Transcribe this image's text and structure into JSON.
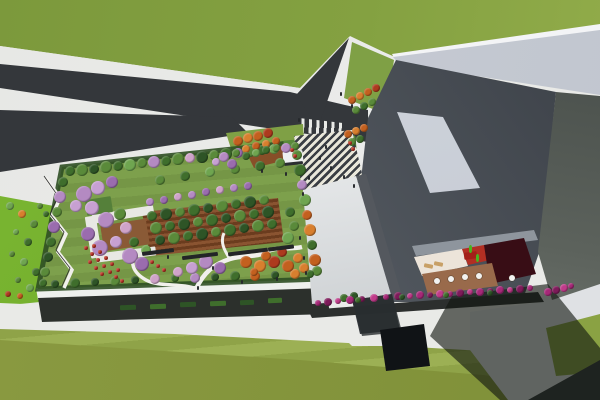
{
  "scene": {
    "description": "Aerial 3D architectural rendering: rooftop garden park over a long low building, Y-shaped asphalt road through lawns, grand striped entry stair plaza, angular dark-gray tower slabs with a courtyard terrace, cafe tables and magenta flower beds",
    "canvas": {
      "width": 600,
      "height": 400
    }
  },
  "palette": {
    "lawn_stripe_a": "#9cb054",
    "lawn_stripe_b": "#8fa348",
    "lawn_fore": "#8a9a41",
    "lawn_fore2": "#7f9038",
    "slope_green": "#7cb832",
    "road": "#34373b",
    "road_dark": "#2b2e32",
    "sidewalk": "#e9eae7",
    "garden_lawn": "#7da04c",
    "garden_lawn2": "#759646",
    "hedge": "#2f4f24",
    "g1": "#3f6e2c",
    "g2": "#5a8a3a",
    "g3": "#6fa550",
    "g4": "#2e5426",
    "p1": "#b48ac2",
    "p2": "#c7a0d2",
    "p3": "#9a6cae",
    "pk": "#cfa3c9",
    "o1": "#c3601f",
    "o2": "#d87f2e",
    "r1": "#ad3a1e",
    "rf": "#c03526",
    "path": "#f1f0ec",
    "pergola": "#6b3c1e",
    "pergola_l": "#8a5431",
    "bench": "#232527",
    "wall_dark": "#2c302c",
    "fascia": "#eef0ed",
    "fascia2": "#e8e8e3",
    "deck2": "#8a5a36",
    "groof": "#55803a",
    "canopy_w": "#eef0f1",
    "roof_edge": "#f3f4f6",
    "terrace_cream": "#ece4d9",
    "terrace_red": "#b22f23",
    "terrace_maroon": "#380d15",
    "deck": "#996a4b",
    "table_white": "#f2f2f0",
    "fig_green": "#49b41e",
    "chair_tan": "#c8a066",
    "red_wall": "#a32018",
    "fl1": "#a62878",
    "fl2": "#7e1b5a",
    "fl3": "#c03b8a",
    "planter": "#2c2f2e",
    "shadow": "rgba(18,22,16,0.62)",
    "leg_dark": "#101316",
    "ground_light": "#dfe1e4",
    "stair_a": "#3a3e44",
    "stair_b": "#e9e7da",
    "people": "#26292c"
  },
  "scatter": {
    "garden_trees": [
      [
        70,
        171,
        5,
        "g1"
      ],
      [
        82,
        170,
        6,
        "g2"
      ],
      [
        94,
        169,
        5,
        "g4"
      ],
      [
        106,
        167,
        6,
        "g2"
      ],
      [
        118,
        166,
        5,
        "g1"
      ],
      [
        130,
        165,
        6,
        "g3"
      ],
      [
        142,
        163,
        5,
        "g2"
      ],
      [
        154,
        162,
        6,
        "p1"
      ],
      [
        166,
        161,
        5,
        "g1"
      ],
      [
        178,
        159,
        6,
        "g2"
      ],
      [
        190,
        158,
        5,
        "pk"
      ],
      [
        202,
        157,
        6,
        "g4"
      ],
      [
        214,
        155,
        5,
        "g2"
      ],
      [
        226,
        154,
        6,
        "g1"
      ],
      [
        238,
        153,
        5,
        "p3"
      ],
      [
        250,
        151,
        6,
        "g2"
      ],
      [
        262,
        150,
        5,
        "g1"
      ],
      [
        274,
        149,
        5,
        "g3"
      ],
      [
        286,
        148,
        5,
        "p1"
      ],
      [
        295,
        146,
        4,
        "g2"
      ],
      [
        297,
        155,
        5,
        "g2"
      ],
      [
        300,
        170,
        6,
        "g1"
      ],
      [
        302,
        185,
        5,
        "p1"
      ],
      [
        305,
        200,
        6,
        "g3"
      ],
      [
        307,
        215,
        5,
        "o1"
      ],
      [
        310,
        230,
        6,
        "o2"
      ],
      [
        312,
        245,
        5,
        "g1"
      ],
      [
        315,
        260,
        6,
        "o1"
      ],
      [
        317,
        271,
        5,
        "g2"
      ],
      [
        55,
        284,
        4,
        "g4"
      ],
      [
        75,
        283,
        5,
        "g1"
      ],
      [
        95,
        282,
        4,
        "g4"
      ],
      [
        115,
        281,
        5,
        "g2"
      ],
      [
        135,
        280,
        4,
        "g4"
      ],
      [
        155,
        279,
        5,
        "pk"
      ],
      [
        175,
        278,
        4,
        "g1"
      ],
      [
        195,
        278,
        5,
        "p1"
      ],
      [
        215,
        277,
        4,
        "g4"
      ],
      [
        235,
        276,
        5,
        "g1"
      ],
      [
        255,
        276,
        5,
        "o1"
      ],
      [
        275,
        275,
        4,
        "g4"
      ],
      [
        295,
        274,
        5,
        "o2"
      ],
      [
        310,
        274,
        4,
        "g1"
      ],
      [
        63,
        182,
        5,
        "g1"
      ],
      [
        60,
        197,
        6,
        "p1"
      ],
      [
        57,
        212,
        5,
        "g2"
      ],
      [
        54,
        227,
        6,
        "p3"
      ],
      [
        51,
        242,
        5,
        "g1"
      ],
      [
        48,
        257,
        5,
        "g4"
      ],
      [
        45,
        272,
        5,
        "g2"
      ],
      [
        43,
        283,
        4,
        "g1"
      ],
      [
        84,
        194,
        8,
        "p1"
      ],
      [
        98,
        188,
        7,
        "p2"
      ],
      [
        112,
        182,
        6,
        "p3"
      ],
      [
        92,
        208,
        7,
        "p2"
      ],
      [
        106,
        220,
        8,
        "p1"
      ],
      [
        88,
        234,
        7,
        "p3"
      ],
      [
        100,
        248,
        8,
        "p1"
      ],
      [
        116,
        242,
        6,
        "p2"
      ],
      [
        130,
        256,
        8,
        "p1"
      ],
      [
        142,
        264,
        7,
        "p3"
      ],
      [
        126,
        228,
        6,
        "pk"
      ],
      [
        76,
        206,
        6,
        "p2"
      ],
      [
        120,
        214,
        6,
        "g2"
      ],
      [
        134,
        242,
        5,
        "g1"
      ],
      [
        146,
        250,
        5,
        "g3"
      ],
      [
        150,
        202,
        4,
        "p1"
      ],
      [
        164,
        200,
        4,
        "p3"
      ],
      [
        178,
        197,
        4,
        "pk"
      ],
      [
        192,
        195,
        4,
        "p1"
      ],
      [
        206,
        192,
        4,
        "p3"
      ],
      [
        220,
        190,
        4,
        "pk"
      ],
      [
        234,
        188,
        4,
        "p1"
      ],
      [
        248,
        186,
        4,
        "p3"
      ],
      [
        160,
        180,
        5,
        "g2"
      ],
      [
        185,
        176,
        5,
        "g1"
      ],
      [
        210,
        172,
        5,
        "g3"
      ],
      [
        235,
        169,
        5,
        "g2"
      ],
      [
        260,
        166,
        5,
        "g1"
      ],
      [
        280,
        163,
        5,
        "g2"
      ],
      [
        152,
        216,
        5,
        "g1"
      ],
      [
        166,
        214,
        6,
        "g4"
      ],
      [
        180,
        212,
        5,
        "g2"
      ],
      [
        194,
        210,
        6,
        "g1"
      ],
      [
        208,
        208,
        5,
        "g4"
      ],
      [
        222,
        206,
        6,
        "g2"
      ],
      [
        236,
        204,
        5,
        "g1"
      ],
      [
        250,
        202,
        6,
        "g4"
      ],
      [
        264,
        200,
        5,
        "g2"
      ],
      [
        156,
        228,
        6,
        "g2"
      ],
      [
        170,
        226,
        5,
        "g1"
      ],
      [
        184,
        224,
        6,
        "g4"
      ],
      [
        198,
        222,
        5,
        "g2"
      ],
      [
        212,
        220,
        6,
        "g1"
      ],
      [
        226,
        218,
        5,
        "g4"
      ],
      [
        240,
        216,
        6,
        "g2"
      ],
      [
        254,
        214,
        5,
        "g1"
      ],
      [
        268,
        212,
        6,
        "g4"
      ],
      [
        160,
        240,
        5,
        "g4"
      ],
      [
        174,
        238,
        6,
        "g2"
      ],
      [
        188,
        236,
        5,
        "g1"
      ],
      [
        202,
        234,
        6,
        "g4"
      ],
      [
        216,
        232,
        5,
        "g2"
      ],
      [
        230,
        230,
        6,
        "g1"
      ],
      [
        244,
        228,
        5,
        "g4"
      ],
      [
        258,
        226,
        6,
        "g2"
      ],
      [
        272,
        224,
        5,
        "g1"
      ],
      [
        246,
        262,
        6,
        "o1"
      ],
      [
        260,
        266,
        6,
        "o2"
      ],
      [
        274,
        262,
        6,
        "r1"
      ],
      [
        288,
        266,
        6,
        "o1"
      ],
      [
        298,
        258,
        5,
        "o2"
      ],
      [
        282,
        252,
        5,
        "r1"
      ],
      [
        266,
        256,
        5,
        "o1"
      ],
      [
        304,
        268,
        5,
        "o2"
      ],
      [
        254,
        272,
        4,
        "o1"
      ],
      [
        206,
        262,
        7,
        "p1"
      ],
      [
        220,
        268,
        6,
        "p3"
      ],
      [
        192,
        268,
        6,
        "p2"
      ],
      [
        178,
        272,
        5,
        "pk"
      ],
      [
        288,
        238,
        6,
        "g3"
      ],
      [
        294,
        226,
        5,
        "g2"
      ],
      [
        290,
        212,
        5,
        "g1"
      ]
    ],
    "plaza_trees": [
      [
        238,
        141,
        5,
        "o1"
      ],
      [
        248,
        138,
        5,
        "o2"
      ],
      [
        258,
        136,
        5,
        "o1"
      ],
      [
        268,
        133,
        5,
        "r1"
      ],
      [
        246,
        149,
        4,
        "o2"
      ],
      [
        256,
        146,
        4,
        "o1"
      ],
      [
        266,
        144,
        4,
        "o2"
      ],
      [
        276,
        141,
        4,
        "o1"
      ],
      [
        224,
        157,
        5,
        "p1"
      ],
      [
        232,
        164,
        5,
        "p3"
      ],
      [
        216,
        162,
        4,
        "p2"
      ],
      [
        236,
        153,
        4,
        "g2"
      ],
      [
        246,
        156,
        4,
        "g1"
      ],
      [
        256,
        153,
        4,
        "g3"
      ],
      [
        266,
        150,
        4,
        "g1"
      ],
      [
        276,
        148,
        4,
        "g2"
      ],
      [
        348,
        134,
        4,
        "o1"
      ],
      [
        356,
        131,
        4,
        "o2"
      ],
      [
        364,
        128,
        4,
        "o1"
      ],
      [
        352,
        142,
        4,
        "g2"
      ],
      [
        360,
        139,
        4,
        "g1"
      ],
      [
        352,
        100,
        4,
        "o1"
      ],
      [
        360,
        96,
        4,
        "o2"
      ],
      [
        368,
        92,
        4,
        "o1"
      ],
      [
        376,
        88,
        4,
        "r1"
      ],
      [
        356,
        110,
        4,
        "g2"
      ],
      [
        364,
        106,
        4,
        "g1"
      ],
      [
        372,
        102,
        4,
        "g2"
      ],
      [
        344,
        298,
        4,
        "g1"
      ],
      [
        354,
        296,
        4,
        "g4"
      ]
    ],
    "slope_shrubs": [
      [
        10,
        206,
        4,
        "g3"
      ],
      [
        22,
        214,
        4,
        "o2"
      ],
      [
        34,
        224,
        4,
        "g2"
      ],
      [
        16,
        232,
        3,
        "g3"
      ],
      [
        28,
        242,
        4,
        "g1"
      ],
      [
        12,
        254,
        3,
        "g2"
      ],
      [
        24,
        262,
        4,
        "g3"
      ],
      [
        36,
        272,
        4,
        "g1"
      ],
      [
        18,
        280,
        3,
        "g2"
      ],
      [
        30,
        288,
        4,
        "g3"
      ],
      [
        8,
        294,
        3,
        "r1"
      ],
      [
        20,
        296,
        3,
        "o1"
      ],
      [
        40,
        206,
        3,
        "g2"
      ],
      [
        46,
        214,
        3,
        "g1"
      ]
    ],
    "red_flowers": [
      [
        86,
        248
      ],
      [
        92,
        254
      ],
      [
        98,
        260
      ],
      [
        104,
        266
      ],
      [
        110,
        272
      ],
      [
        116,
        277
      ],
      [
        122,
        281
      ],
      [
        94,
        246
      ],
      [
        100,
        252
      ],
      [
        106,
        258
      ],
      [
        112,
        264
      ],
      [
        118,
        270
      ],
      [
        90,
        262
      ],
      [
        96,
        268
      ],
      [
        102,
        274
      ],
      [
        152,
        262
      ],
      [
        158,
        266
      ],
      [
        164,
        270
      ],
      [
        292,
        150
      ],
      [
        295,
        156
      ],
      [
        350,
        143
      ],
      [
        353,
        149
      ]
    ],
    "magenta_flowers": [
      [
        318,
        303,
        3,
        "fl1"
      ],
      [
        328,
        302,
        4,
        "fl2"
      ],
      [
        338,
        301,
        3,
        "fl3"
      ],
      [
        350,
        300,
        4,
        "fl1"
      ],
      [
        362,
        299,
        3,
        "fl2"
      ],
      [
        374,
        298,
        4,
        "fl3"
      ],
      [
        386,
        297,
        3,
        "fl1"
      ],
      [
        398,
        296,
        4,
        "fl2"
      ],
      [
        410,
        296,
        3,
        "fl3"
      ],
      [
        420,
        295,
        4,
        "fl1"
      ],
      [
        430,
        295,
        3,
        "fl2"
      ],
      [
        440,
        294,
        4,
        "fl3"
      ],
      [
        450,
        294,
        3,
        "fl1"
      ],
      [
        460,
        293,
        4,
        "fl2"
      ],
      [
        470,
        292,
        3,
        "fl3"
      ],
      [
        480,
        292,
        4,
        "fl1"
      ],
      [
        490,
        291,
        3,
        "fl2"
      ],
      [
        500,
        290,
        4,
        "fl1"
      ],
      [
        510,
        290,
        3,
        "fl3"
      ],
      [
        520,
        289,
        4,
        "fl2"
      ],
      [
        530,
        288,
        3,
        "fl1"
      ],
      [
        548,
        292,
        4,
        "fl1"
      ],
      [
        556,
        290,
        4,
        "fl2"
      ],
      [
        564,
        288,
        4,
        "fl3"
      ],
      [
        571,
        286,
        3,
        "fl1"
      ],
      [
        358,
        300,
        3,
        "g1"
      ],
      [
        402,
        297,
        3,
        "g4"
      ],
      [
        446,
        295,
        3,
        "g1"
      ],
      [
        490,
        293,
        3,
        "g4"
      ]
    ],
    "people": [
      [
        320,
        158
      ],
      [
        331,
        168
      ],
      [
        326,
        147
      ],
      [
        344,
        177
      ],
      [
        309,
        178
      ],
      [
        354,
        186
      ],
      [
        303,
        194
      ],
      [
        300,
        238
      ],
      [
        304,
        258
      ],
      [
        341,
        94
      ],
      [
        352,
        106
      ],
      [
        299,
        120
      ],
      [
        262,
        171
      ],
      [
        286,
        174
      ],
      [
        168,
        257
      ],
      [
        198,
        288
      ],
      [
        242,
        282
      ],
      [
        277,
        279
      ],
      [
        213,
        268
      ],
      [
        306,
        273
      ]
    ],
    "tables": [
      [
        437,
        281
      ],
      [
        451,
        279
      ],
      [
        465,
        277
      ],
      [
        479,
        276
      ],
      [
        512,
        278
      ]
    ],
    "green_figures": [
      [
        470,
        249
      ],
      [
        477,
        258
      ]
    ]
  },
  "rects": {
    "pavilion": [
      [
        92,
        210,
        62,
        9,
        -9,
        "fascia2"
      ],
      [
        88,
        216,
        11,
        42,
        -9,
        "fascia2"
      ],
      [
        96,
        250,
        60,
        9,
        -7,
        "fascia2"
      ],
      [
        102,
        222,
        46,
        26,
        -9,
        "deck2"
      ],
      [
        86,
        198,
        26,
        16,
        -9,
        "groof"
      ]
    ],
    "benches": [
      [
        142,
        250,
        32,
        4,
        -7,
        "bench"
      ],
      [
        182,
        254,
        36,
        4,
        -7,
        "bench"
      ],
      [
        228,
        250,
        40,
        4,
        -7,
        "bench"
      ],
      [
        268,
        246,
        26,
        4,
        -7,
        "bench"
      ]
    ],
    "green_wall": [
      [
        120,
        305,
        16,
        5,
        -2,
        "g4"
      ],
      [
        150,
        304,
        16,
        5,
        -2,
        "g1"
      ],
      [
        180,
        302,
        16,
        5,
        -2,
        "g4"
      ],
      [
        210,
        301,
        16,
        5,
        -2,
        "g1"
      ],
      [
        240,
        300,
        14,
        5,
        -2,
        "g4"
      ],
      [
        268,
        298,
        14,
        5,
        -2,
        "g1"
      ]
    ],
    "stair_planters": [
      [
        284,
        140,
        16,
        16,
        -5,
        "g2"
      ],
      [
        342,
        136,
        14,
        14,
        -5,
        "g2"
      ]
    ],
    "canopy": [
      [
        283,
        151,
        20,
        12,
        -6,
        "canopy_w"
      ],
      [
        284,
        162,
        19,
        3,
        -6,
        "road_dark"
      ]
    ],
    "lounge_chairs": [
      [
        424,
        264,
        9,
        4,
        12,
        "chair_tan"
      ],
      [
        434,
        262,
        9,
        4,
        12,
        "chair_tan"
      ]
    ],
    "red_wall_piece": [
      [
        464,
        252,
        13,
        7,
        -8,
        "red_wall"
      ]
    ]
  }
}
